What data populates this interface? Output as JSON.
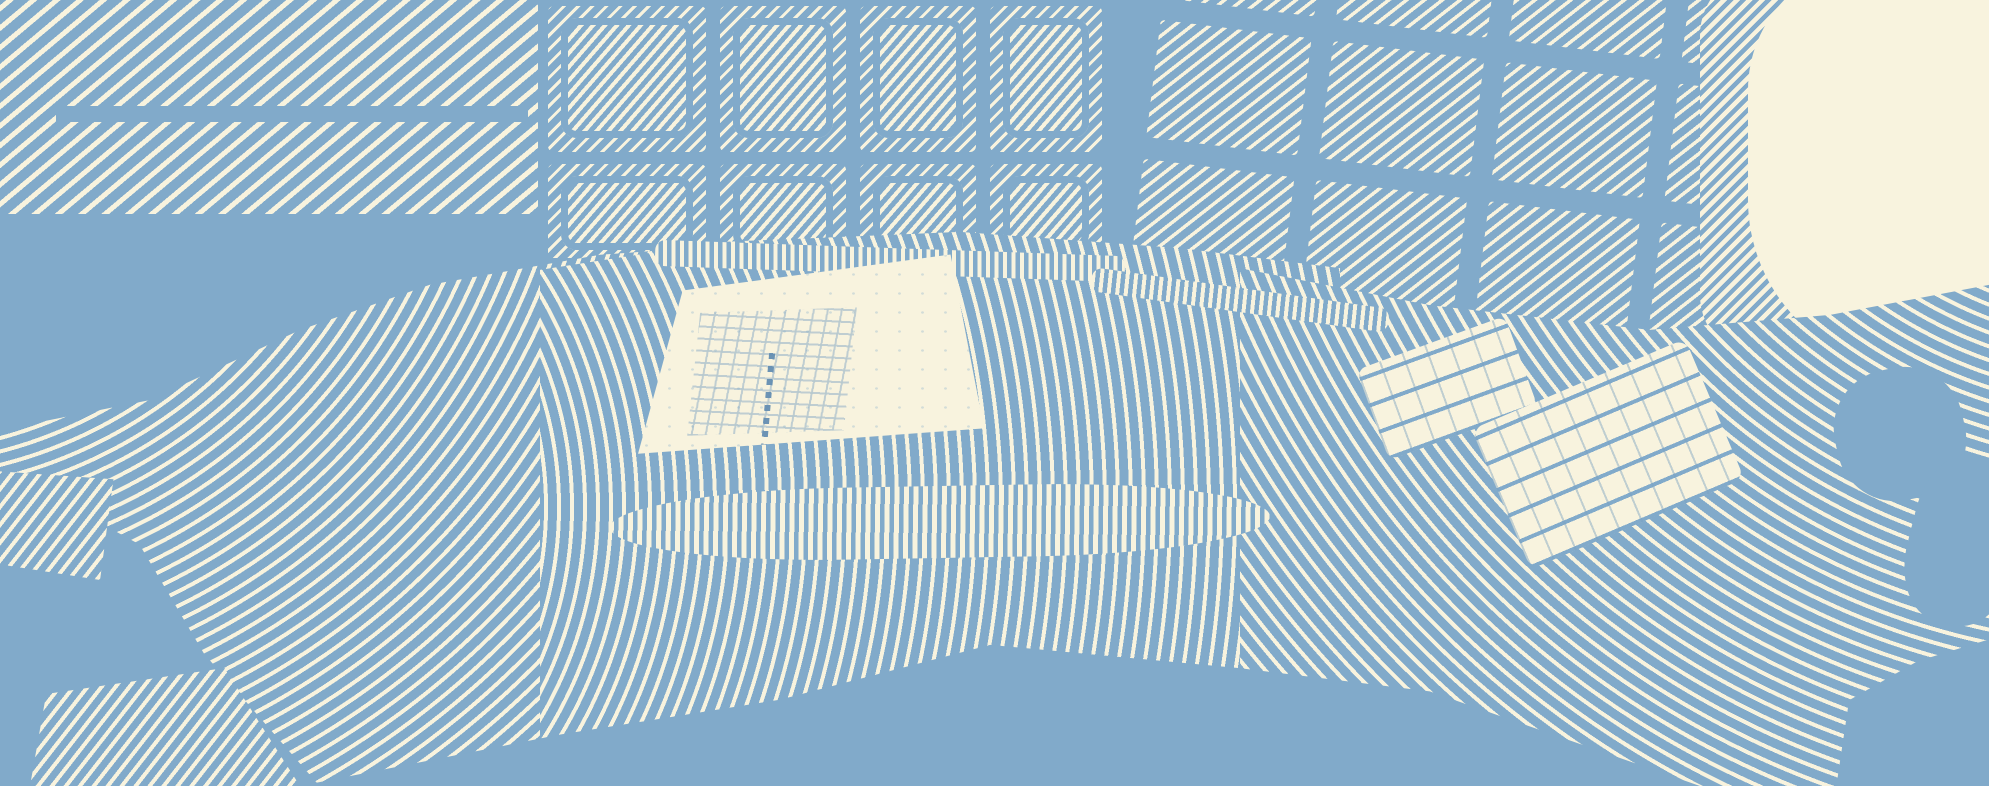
{
  "scene": {
    "description": "Duotone engraved halftone illustration of an empty control room: a large wall display and a rack of eight CRT monitors above a curved console desk, a tilted grid of twelve wall monitors on the right beside a bright lit corner, a cream keyboard panel recessed in the center of the desk, two keyboards on the right side of the desk, and chair and floor shadows in the foreground.",
    "style": "engraving-halftone",
    "counts": {
      "large_wall_display_panels": 2,
      "crt_rack_columns": 4,
      "crt_rack_rows": 2,
      "side_wall_columns": 4,
      "side_wall_rows": 3,
      "desk_keyboards": 3
    }
  },
  "palette": {
    "ink_blue": "#81aaca",
    "paper_cream": "#f8f3de"
  }
}
